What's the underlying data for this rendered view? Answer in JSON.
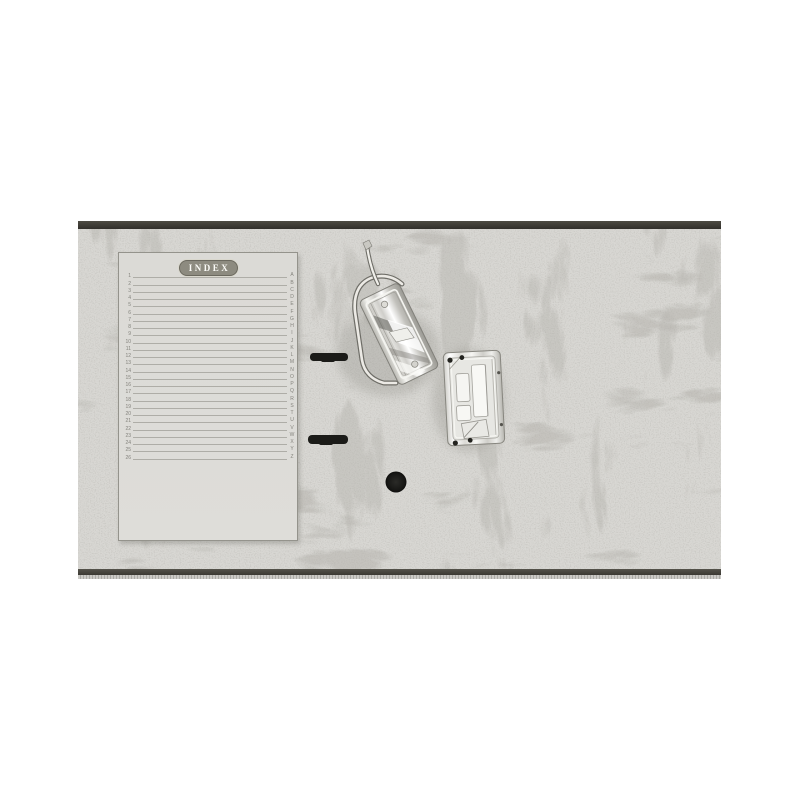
{
  "photo": {
    "description": "Open grey marbled lever arch file binder interior with detached chrome lever-arch mechanism, base plate, spine slots and spine hole",
    "index_sheet": {
      "title": "INDEX",
      "row_numbers": [
        "1",
        "2",
        "3",
        "4",
        "5",
        "6",
        "7",
        "8",
        "9",
        "10",
        "11",
        "12",
        "13",
        "14",
        "15",
        "16",
        "17",
        "18",
        "19",
        "20",
        "21",
        "22",
        "23",
        "24",
        "25",
        "26"
      ],
      "letters": [
        "A",
        "B",
        "C",
        "D",
        "E",
        "F",
        "G",
        "H",
        "I",
        "J",
        "K",
        "L",
        "M",
        "N",
        "O",
        "P",
        "Q",
        "R",
        "S",
        "T",
        "U",
        "V",
        "W",
        "X",
        "Y",
        "Z"
      ]
    },
    "colors": {
      "background": "#ffffff",
      "binder_base": "#d8d7d3",
      "binder_vein": "#85847e",
      "top_edge": "#3a3833",
      "sheet": "#dcdbd7",
      "badge_fill": "#8d8b80",
      "badge_text": "#fbfbf7",
      "rule_line": "#aeada7",
      "hardware_black": "#1b1b18",
      "metal_light": "#f5f5f2",
      "metal_dark": "#8f8e89"
    }
  }
}
